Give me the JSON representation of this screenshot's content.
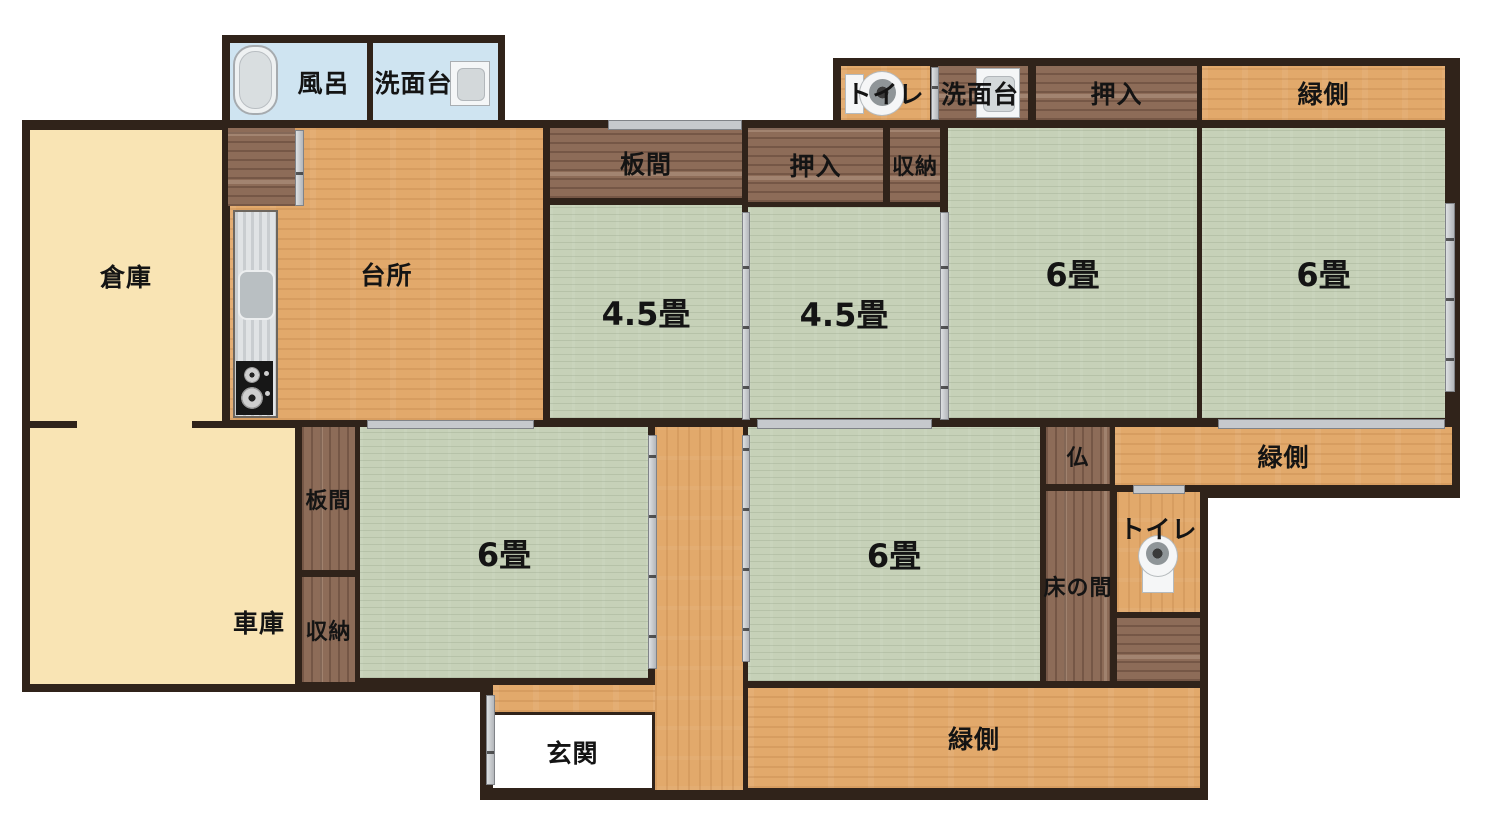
{
  "title": "間取り図 (floor plan)",
  "rooms": {
    "bath": {
      "label": "風呂"
    },
    "washstand_top_left": {
      "label": "洗面台"
    },
    "toilet_top": {
      "label": "トイレ"
    },
    "washstand_top_right": {
      "label": "洗面台"
    },
    "oshiire_top": {
      "label": "押入"
    },
    "engawa_top": {
      "label": "緑側"
    },
    "souko": {
      "label": "倉庫"
    },
    "daidokoro": {
      "label": "台所"
    },
    "itama_top": {
      "label": "板間"
    },
    "tatami45_left": {
      "label": "4.5畳"
    },
    "oshiire_mid": {
      "label": "押入"
    },
    "shuno_mid": {
      "label": "収納"
    },
    "tatami45_right": {
      "label": "4.5畳"
    },
    "rokujo_top_left": {
      "label": "6畳"
    },
    "rokujo_top_right": {
      "label": "6畳"
    },
    "engawa_right": {
      "label": "緑側"
    },
    "itama_left": {
      "label": "板間"
    },
    "shuno_left": {
      "label": "収納"
    },
    "shako": {
      "label": "車庫"
    },
    "rokujo_bottom_left": {
      "label": "6畳"
    },
    "rokujo_bottom_mid": {
      "label": "6畳"
    },
    "butsu": {
      "label": "仏"
    },
    "tokonoma": {
      "label": "床の間"
    },
    "toilet_bottom": {
      "label": "トイレ"
    },
    "genkan": {
      "label": "玄関"
    },
    "engawa_bottom": {
      "label": "緑側"
    }
  },
  "icons": [
    "bathtub-icon",
    "sink-icon",
    "kitchen-sink-icon",
    "stove-icon",
    "toilet-icon"
  ],
  "colors": {
    "wall": "#30231a",
    "tatami": "#c6d1b8",
    "wood_light": "#e2a96b",
    "wood_dark": "#8d6c58",
    "storage_cream": "#f9e4b4",
    "bath_blue": "#cfe4f1",
    "rail_gray": "#c6c9cd",
    "background": "#ffffff"
  }
}
